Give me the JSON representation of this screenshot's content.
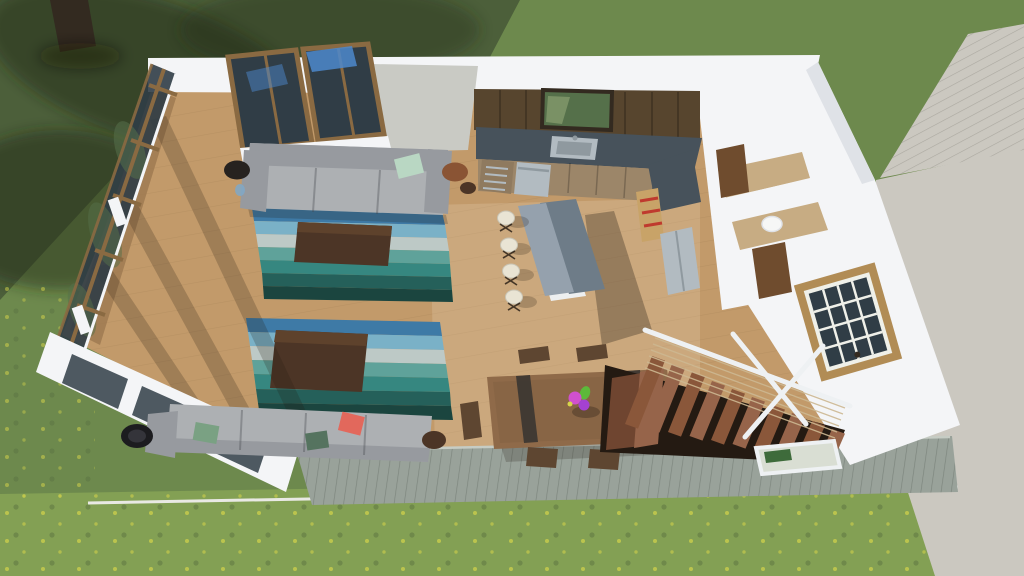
{
  "meta": {
    "title": "Aerial dollhouse cutaway 3D rendering of a modern open-plan house: living room with glass window wall, striped teal rugs, gray sofas, kitchen with island and bar stools, dining table with flowers, exterior wood stairs to a gray deck, lawn with tree shadows and concrete patio"
  },
  "palette": {
    "wall_bright": "#f4f5f7",
    "wall_face": "#c9cac4",
    "wall_shade": "#dfe2e7",
    "glass_dark": "#303d46",
    "glass_green": "#55704a",
    "sky_blue": "#4c88cc",
    "frame_wood": "#8a6a42",
    "window_tan": "#b18c55",
    "window_grid": "#eff0e9",
    "floor_wood": "#c29a6a",
    "floor_dark": "#9c7850",
    "floor_line": "rgba(110,80,45,0.22)",
    "floor_sun": "rgba(255,245,225,0.16)",
    "fence_wood": "#99a29a",
    "fence_line": "rgba(90,100,90,0.45)",
    "fence_light": "#c6ccc4",
    "curb": "#e9e9e4",
    "grass_mid": "#6d894d",
    "grass_dark": "#4c5f3a",
    "grass_bright": "#83a054",
    "flower_yellow": "#d6d54a",
    "canopy_shadow": "rgba(30,42,24,0.5)",
    "trunk": "#332a20",
    "concrete": "#cbc8c0",
    "deck_line": "rgba(150,147,138,0.6)",
    "sofa_gray": "#adb0b3",
    "sofa_shade": "#979a9f",
    "sofa_line": "rgba(70,72,78,0.35)",
    "pillow_mint": "#b9d7c3",
    "pillow_sage": "#7aa183",
    "pillow_green": "#55735f",
    "pillow_coral": "#e2685c",
    "table_black": "#26221f",
    "table_copper": "#8a5434",
    "chair_black": "#1c1c1f",
    "vase_blue": "#7fa8c8",
    "rug_blue": "#3e7aa6",
    "rug_skyblue": "#7ab1c7",
    "rug_pale": "#bdc9c6",
    "rug_teal": "#5fa29a",
    "rug_green": "#368780",
    "rug_deep": "#25605a",
    "rug_dark": "#1b453f",
    "ctable_wood": "#4c3526",
    "ctable_top": "#5e422c",
    "cab_dark": "#57452e",
    "cab_taupe": "#9c8669",
    "counter_slate": "#47525b",
    "island_light": "#95a1ad",
    "island_dark": "#6e7c88",
    "island_base": "#edeff0",
    "stool_cream": "#e9e4d4",
    "steel": "#b2bbc1",
    "steel_dark": "#8f999f",
    "red_accent": "#bf3a2e",
    "shelf_tan": "#c8a368",
    "door_brown": "#6f4c2e",
    "bath_floor": "#c7ac83",
    "toilet_white": "#f6f7f6",
    "dtable_wood": "#8f6a49",
    "dtable_stripe": "#3a3531",
    "dchair_wood": "#5e4631",
    "dchair_seat": "#7a5b3e",
    "flower_pink": "#d050ce",
    "flower_purple": "#a441d2",
    "flower_stem": "#5cb93a",
    "tread_wood": "#8a573a",
    "tread_alt": "#96644a",
    "tread_dark": "#6f4530",
    "stair_void": "#241a12",
    "rail_white": "#eef1f3",
    "cable_tan": "#cdb892",
    "landing_pane": "#d9ded3",
    "planter_green": "#3e6b3b",
    "shadow_soft": "rgba(35,28,20,0.22)",
    "shadow_mid": "rgba(30,24,16,0.3)",
    "shadow_strong": "rgba(22,17,11,0.42)"
  },
  "scene": {
    "environment": [
      "lawn with tree canopy shadows",
      "tree trunk",
      "yellow wildflowers in sunlit grass",
      "concrete patio and path (right)",
      "weathered gray deck boards (bottom)"
    ],
    "rooms": [
      "living room",
      "kitchen",
      "hallway with bathroom",
      "side room with paned window",
      "dining area",
      "exterior stair to deck"
    ],
    "furniture": [
      "gray three-seat sofa with mint pillow",
      "two striped teal patchwork rugs",
      "two dark wood coffee tables",
      "gray sectional sofa with sage and coral pillows",
      "black round lounge chair",
      "round side tables",
      "kitchen cabinets and slate counter",
      "sink and dishwasher",
      "refrigerator",
      "red-accent pantry shelf",
      "two-tier kitchen island",
      "four cream bar stools",
      "wood dining table with flower centerpiece",
      "five dining chairs",
      "open-riser wood staircase with cable railing",
      "white stair rails",
      "deck planter"
    ]
  }
}
